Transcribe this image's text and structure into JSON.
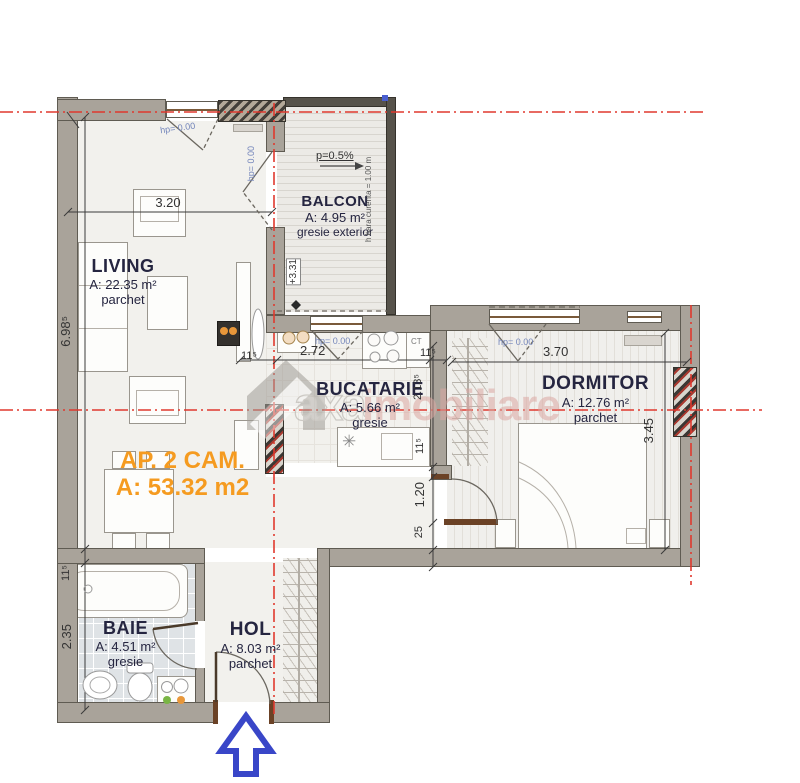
{
  "title": {
    "line1": "AP. 2 CAM.",
    "line2": "A: 53.32 m2"
  },
  "rooms": {
    "living": {
      "name": "LIVING",
      "area": "A: 22.35 m²",
      "floor": "parchet"
    },
    "balcon": {
      "name": "BALCON",
      "area": "A: 4.95 m²",
      "floor": "gresie exterior"
    },
    "bucatarie": {
      "name": "BUCATARIE",
      "area": "A: 5.66 m²",
      "floor": "gresie"
    },
    "dormitor": {
      "name": "DORMITOR",
      "area": "A: 12.76 m²",
      "floor": "parchet"
    },
    "baie": {
      "name": "BAIE",
      "area": "A: 4.51 m²",
      "floor": "gresie"
    },
    "hol": {
      "name": "HOL",
      "area": "A: 8.03 m²",
      "floor": "parchet"
    }
  },
  "dims": {
    "living_w": "3.20",
    "living_h": "6.98⁵",
    "wall_11": "11⁵",
    "kitchen_w": "2.72",
    "kitchen_h": "2.13⁵",
    "door_h": "1.20",
    "wall_25": "25",
    "dorm_w": "3.70",
    "dorm_h": "3.45",
    "baie_h": "2.35"
  },
  "annotations": {
    "hp": "hp= 0.00",
    "slope": "p=0.5%",
    "railing": "h bara curenta = 1.00 m",
    "level": "+3.31",
    "boiler": "CT",
    "dishwasher": "✳"
  },
  "watermark": {
    "part1": "axa",
    "part2": "imobiliare"
  },
  "colors": {
    "wall": "#a9a39a",
    "red_axis": "#e0392e",
    "accent_orange": "#f59b20",
    "label_blue": "#7486bb",
    "arrow_blue": "#3946c8",
    "watermark_pink": "#dba7a2"
  }
}
